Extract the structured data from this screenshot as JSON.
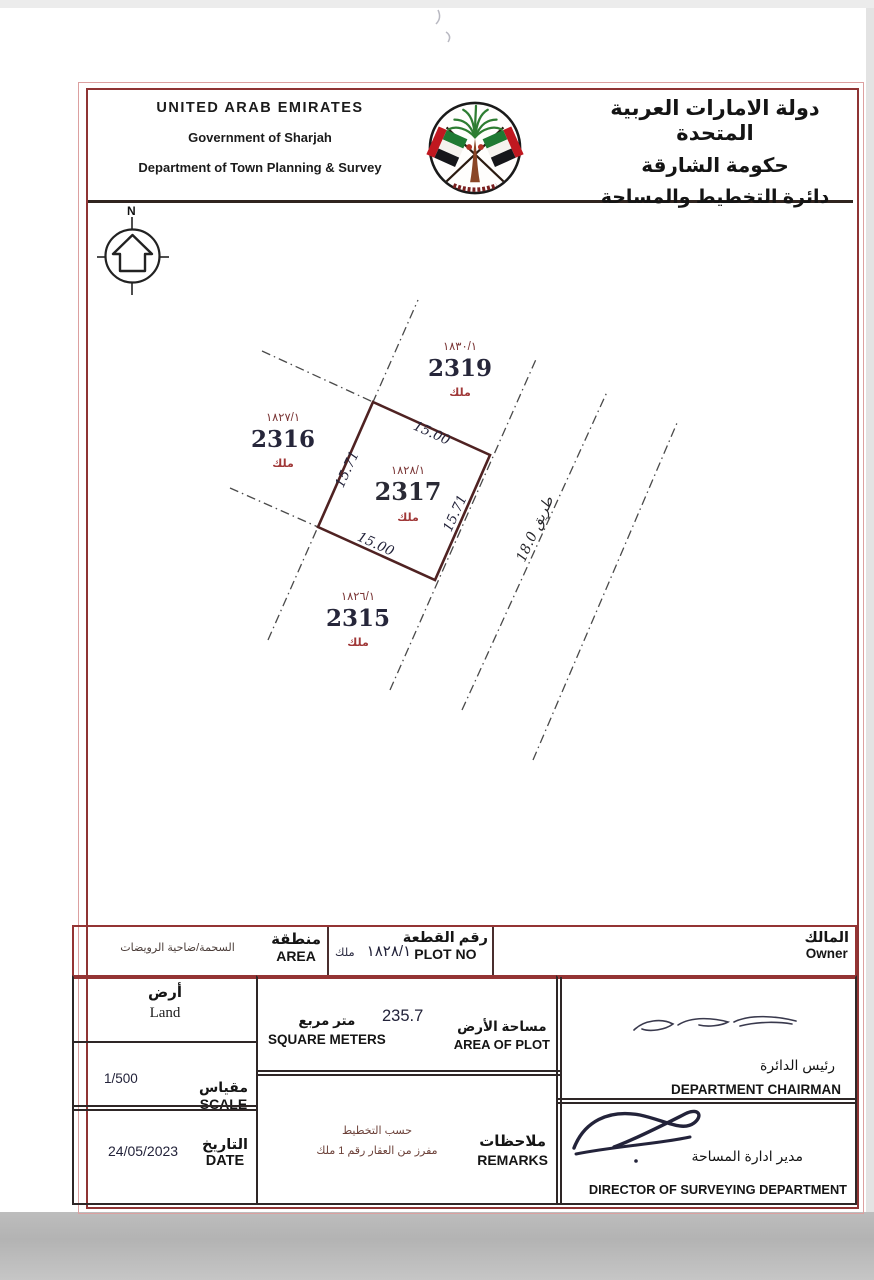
{
  "colors": {
    "border_red": "#943434",
    "plot_outline": "#4f2222",
    "dash_gray": "#4a4a4a",
    "navy_text": "#23233a",
    "maroon_text": "#7a3535",
    "red_text": "#a03838"
  },
  "header": {
    "en_line1": "UNITED ARAB EMIRATES",
    "en_line2": "Government of Sharjah",
    "en_line3": "Department of Town Planning & Survey",
    "ar_line1": "دولة الامارات العربية المتحدة",
    "ar_line2": "حكومة الشارقة",
    "ar_line3": "دائرة التخطيط والمساحة"
  },
  "compass": {
    "north": "N"
  },
  "map": {
    "road_label": "طريق 18.0",
    "dims": {
      "top": "15.00",
      "bottom": "15.00",
      "left": "15.71",
      "right": "15.71"
    },
    "plots": {
      "p2319": {
        "no": "2319",
        "ref": "١٨٣٠/١",
        "tenure": "ملك"
      },
      "p2316": {
        "no": "2316",
        "ref": "١٨٢٧/١",
        "tenure": "ملك"
      },
      "p2317": {
        "no": "2317",
        "ref": "١٨٢٨/١",
        "tenure": "ملك"
      },
      "p2315": {
        "no": "2315",
        "ref": "١٨٢٦/١",
        "tenure": "ملك"
      }
    }
  },
  "table": {
    "owner": {
      "label_ar": "المالك",
      "label_en": "Owner"
    },
    "plot_no": {
      "label_ar": "رقم القطعة",
      "label_en": "PLOT NO",
      "value": "١٨٢٨/١",
      "tenure": "ملك"
    },
    "area": {
      "label_ar": "منطقة",
      "label_en": "AREA",
      "value": "السحمة/ضاحية الرويضات"
    },
    "land": {
      "label_ar": "أرض",
      "label_en": "Land"
    },
    "area_of_plot": {
      "label_ar": "مساحة الأرض",
      "label_en": "AREA OF PLOT",
      "value": "235.7",
      "unit_ar": "متر مربع",
      "unit_en": "SQUARE METERS"
    },
    "chairman": {
      "label_ar": "رئيس الدائرة",
      "label_en": "DEPARTMENT CHAIRMAN"
    },
    "scale": {
      "label_ar": "مقياس",
      "label_en": "SCALE",
      "value": "1/500"
    },
    "date": {
      "label_ar": "التاريخ",
      "label_en": "DATE",
      "value": "24/05/2023"
    },
    "remarks": {
      "label_ar": "ملاحظات",
      "label_en": "REMARKS",
      "line1": "حسب التخطيط",
      "line2": "مفرز من العقار رقم 1 ملك"
    },
    "director": {
      "label_ar": "مدير ادارة المساحة",
      "label_en": "DIRECTOR OF SURVEYING DEPARTMENT"
    }
  }
}
